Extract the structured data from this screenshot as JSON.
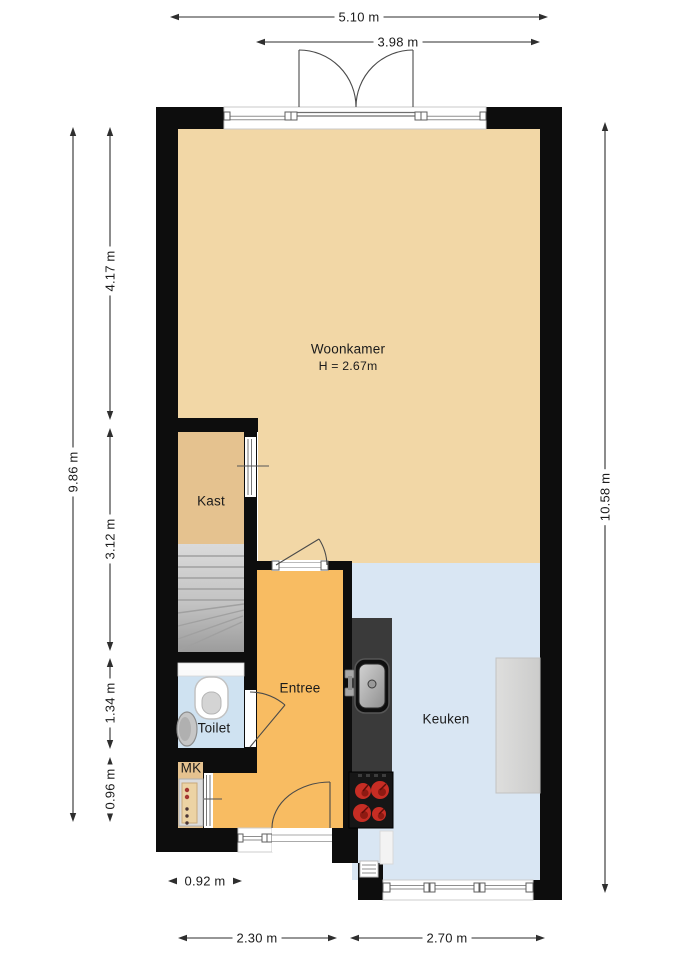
{
  "plan": {
    "rooms": {
      "woonkamer": {
        "label": "Woonkamer",
        "ceiling_height": "H = 2.67m"
      },
      "kast": {
        "label": "Kast"
      },
      "entree": {
        "label": "Entree"
      },
      "toilet": {
        "label": "Toilet"
      },
      "meterkast": {
        "label": "MK"
      },
      "keuken": {
        "label": "Keuken"
      }
    },
    "dimensions": {
      "top_total": "5.10 m",
      "top_inner": "3.98 m",
      "left_total": "9.86 m",
      "left_segments": [
        "4.17 m",
        "3.12 m",
        "1.34 m",
        "0.96 m"
      ],
      "right_total": "10.58 m",
      "bottom_offset": "0.92 m",
      "bottom_left": "2.30 m",
      "bottom_right": "2.70 m"
    },
    "colors": {
      "wall": "#0d0d0d",
      "woonkamer_floor": "#f2d7a6",
      "kast_floor": "#e5c28f",
      "mk_floor": "#e5c28f",
      "entree_floor": "#f8bc62",
      "toilet_floor": "#cfe2f1",
      "keuken_floor": "#d9e6f3",
      "counter": "#3a3a3a",
      "burner_red": "#c62d24",
      "dimension": "#2e2e2e"
    }
  }
}
